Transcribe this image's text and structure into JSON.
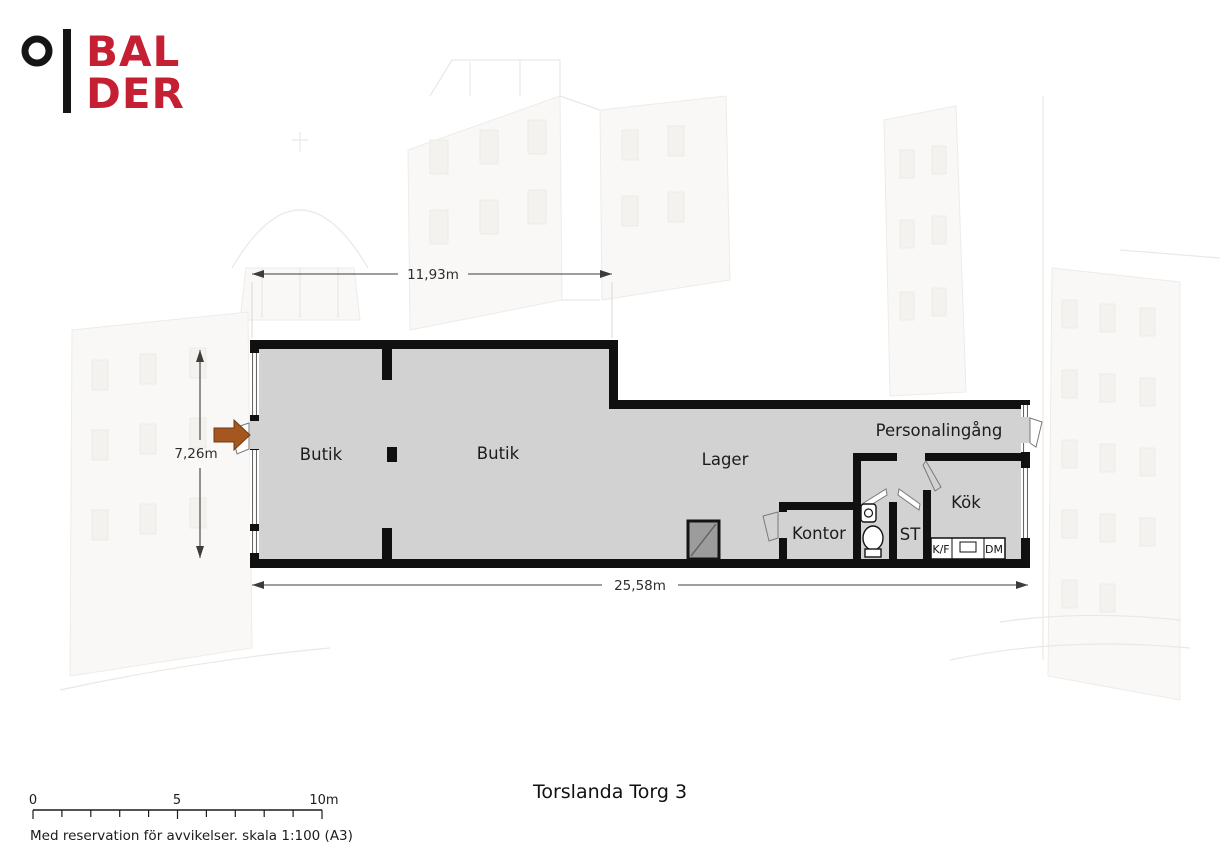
{
  "brand": {
    "logo_line1": "BAL",
    "logo_line2": "DER",
    "logo_mark": "ring-and-bar-icon",
    "brand_red": "#C41F32"
  },
  "plan": {
    "room_labels": [
      "Butik",
      "Butik",
      "Lager",
      "Personalingång",
      "Kontor",
      "ST",
      "Kök"
    ],
    "fixture_labels": {
      "fridge_freezer": "K/F",
      "dishwasher": "DM"
    },
    "dimensions": {
      "top_width": "11,93m",
      "left_height": "7,26m",
      "bottom_width": "25,58m"
    },
    "colors": {
      "floor": "#D2D2D2",
      "wall": "#101010",
      "shaft_fill": "#9C9C9C",
      "entry_arrow": "#A5571F"
    }
  },
  "footer": {
    "title": "Torslanda Torg 3",
    "scale_ticks": [
      "0",
      "5",
      "10m"
    ],
    "disclaimer": "Med reservation för avvikelser. skala 1:100 (A3)"
  }
}
